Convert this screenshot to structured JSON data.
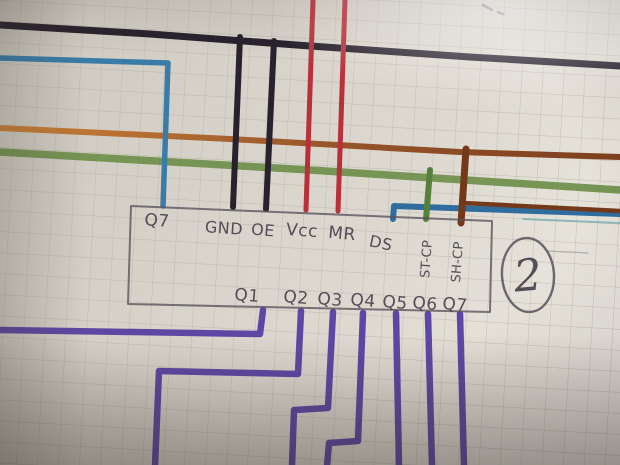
{
  "page": {
    "kind": "photo of hand-drawn wiring diagram on squared paper",
    "circled_number": "2"
  },
  "chip": {
    "top_pins": [
      "Q7",
      "GND",
      "OE",
      "Vcc",
      "MR",
      "DS",
      "ST-CP",
      "SH-CP"
    ],
    "bottom_pins": [
      "Q1",
      "Q2",
      "Q3",
      "Q4",
      "Q5",
      "Q6",
      "Q7"
    ]
  },
  "wires": [
    {
      "name": "top-bus-black",
      "color_key": "black",
      "route": "horizontal across top"
    },
    {
      "name": "gnd-black",
      "color_key": "black",
      "route": "top bus down to GND"
    },
    {
      "name": "oe-black",
      "color_key": "black",
      "route": "top bus down to OE"
    },
    {
      "name": "vcc-red",
      "color_key": "red",
      "route": "top edge down to Vcc"
    },
    {
      "name": "mr-red",
      "color_key": "red",
      "route": "top edge down to MR"
    },
    {
      "name": "q7-top-blue",
      "color_key": "blue",
      "route": "left edge, corner down to Q7"
    },
    {
      "name": "ds-blue",
      "color_key": "blue_ds",
      "route": "DS up, then right to edge"
    },
    {
      "name": "orange-brown-rail",
      "color_key": "orange",
      "route": "horizontal across middle"
    },
    {
      "name": "green-rail",
      "color_key": "green",
      "route": "horizontal across middle"
    },
    {
      "name": "st-cp-green",
      "color_key": "green_dark",
      "route": "green rail down to ST-CP"
    },
    {
      "name": "sh-cp-brown",
      "color_key": "brown",
      "route": "brown rail down to SH-CP"
    },
    {
      "name": "brown-right",
      "color_key": "brown",
      "route": "short run to right edge over blue"
    },
    {
      "name": "teal-thin",
      "color_key": "teal",
      "route": "faint thin line right edge"
    },
    {
      "name": "q1-purple",
      "color_key": "purple",
      "route": "Q1 down, left to edge"
    },
    {
      "name": "q2-purple",
      "color_key": "purple",
      "route": "Q2 down, left, down to bottom"
    },
    {
      "name": "q3-purple",
      "color_key": "purple",
      "route": "Q3 down, jog left, to bottom"
    },
    {
      "name": "q4-purple",
      "color_key": "purple",
      "route": "Q4 down, jog left, to bottom"
    },
    {
      "name": "q5-purple",
      "color_key": "purple",
      "route": "Q5 straight down"
    },
    {
      "name": "q6-purple",
      "color_key": "purple",
      "route": "Q6 straight down"
    },
    {
      "name": "q7-bottom-purple",
      "color_key": "purple",
      "route": "Q7 straight down"
    }
  ],
  "colors": {
    "black": "#28222e",
    "red": "#b9303a",
    "blue": "#3a7ca8",
    "blue_ds": "#2e6d9e",
    "green": "#6e8f4a",
    "green_dark": "#55803a",
    "orange": "#c0733a",
    "brown": "#74391b",
    "teal": "#4f9aa8",
    "purple": "#5c48a4",
    "pencil": "#57525b",
    "handwriting": "#403b46",
    "paper": "#d7d3c9",
    "grid": "#b2ada2"
  }
}
